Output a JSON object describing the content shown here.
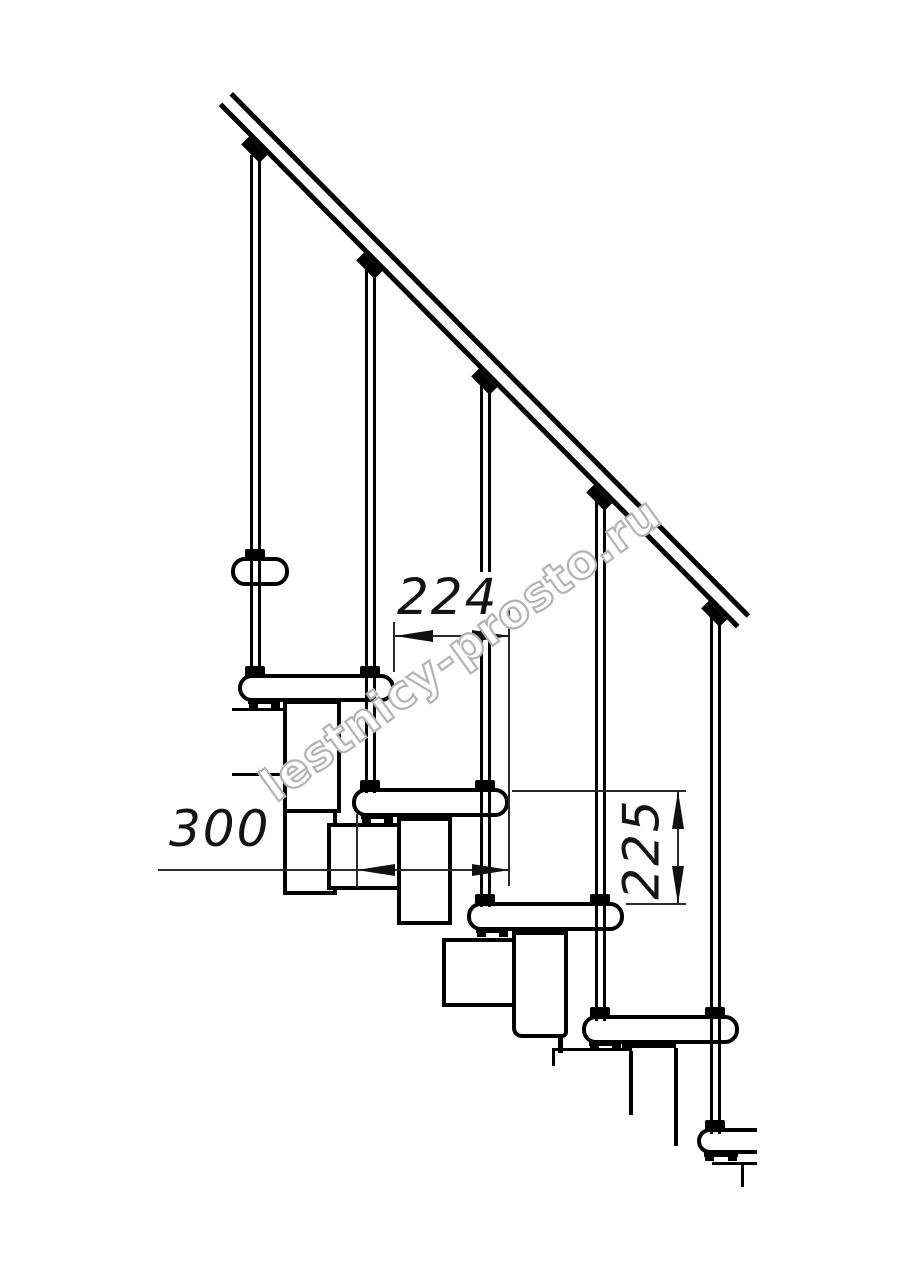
{
  "drawing": {
    "title": "modular-staircase-side-elevation",
    "dimensions": {
      "going_mm": "224",
      "tread_depth_mm": "300",
      "rise_mm": "225"
    },
    "watermark": "lestnicy-prosto.ru",
    "colors": {
      "line": "#000000",
      "dimension_line": "#2b2b2b",
      "watermark_outline": "#b3b3b3",
      "paper": "#ffffff"
    }
  }
}
